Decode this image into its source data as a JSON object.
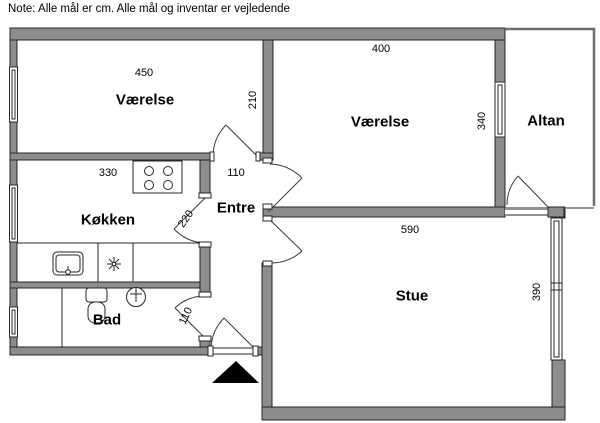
{
  "note": "Note: Alle mål er cm. Alle mål og inventar er vejledende",
  "colors": {
    "wall_fill": "#8c8c8c",
    "wall_outline": "#262626",
    "balcony_outline": "#6e6e6e",
    "entrance_marker": "#000000",
    "background": "#ffffff"
  },
  "rooms": {
    "bedroom_left": {
      "label": "Værelse",
      "width_cm": "450",
      "depth_cm": "210"
    },
    "bedroom_right": {
      "label": "Værelse",
      "width_cm": "400",
      "depth_cm": "340"
    },
    "kitchen": {
      "label": "Køkken",
      "width_cm": "330",
      "door_dim_cm": "220"
    },
    "hall": {
      "label": "Entre",
      "width_cm": "110"
    },
    "bath": {
      "label": "Bad",
      "door_dim_cm": "110"
    },
    "living": {
      "label": "Stue",
      "width_cm": "590",
      "depth_cm": "390"
    },
    "balcony": {
      "label": "Altan"
    }
  }
}
